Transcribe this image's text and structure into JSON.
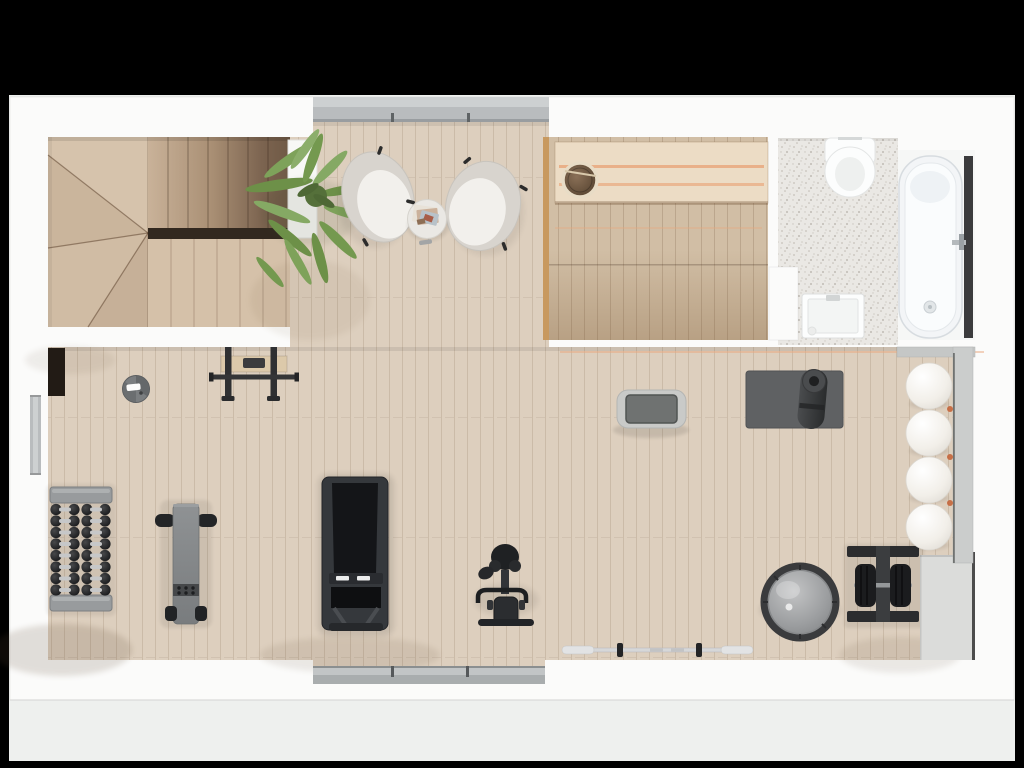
{
  "scene": {
    "type": "floor-plan-top-down-render",
    "title": "Residential floor plan with home gym, sauna and bathroom",
    "rooms": [
      {
        "name": "staircase-hall",
        "items": [
          "winder-staircase",
          "stair-gap",
          "potted-palm",
          "white-planter"
        ]
      },
      {
        "name": "lounge",
        "items": [
          "armchair-left",
          "armchair-right",
          "side-table",
          "magazines",
          "top-window"
        ]
      },
      {
        "name": "sauna",
        "items": [
          "sauna-bench",
          "sauna-bucket",
          "heated-glow-strips"
        ]
      },
      {
        "name": "bathroom",
        "items": [
          "wall-hung-toilet",
          "washbasin",
          "bathtub",
          "bath-mixer",
          "terrazzo-floor"
        ]
      },
      {
        "name": "gym",
        "items": [
          "dumbbell-rack",
          "flat-bench",
          "pull-up-bar",
          "air-purifier",
          "wall-niche",
          "treadmill",
          "exercise-bike",
          "step-platform",
          "yoga-mat",
          "mat-roll",
          "balance-dome",
          "plate-rack",
          "barbell",
          "stability-balls",
          "ball-rack",
          "left-window",
          "bottom-window"
        ]
      }
    ],
    "stability_ball_count": 4,
    "dumbbell_rows": 8,
    "dumbbell_columns": 2
  },
  "colors": {
    "frame": "#000000",
    "backdrop": "#eef0ee",
    "wall": "#fbfbfa",
    "wood_floor": "#ddcfbe",
    "wood_stair_light": "#cfbaa1",
    "wood_stair_dark": "#6f5945",
    "stair_gap": "#32281f",
    "sauna_floor": "#d1bea5",
    "sauna_bench": "#ecdcc5",
    "sauna_glow": "#e9a87e",
    "sauna_wall_edge": "#c8995f",
    "terrazzo_base": "#eae8e4",
    "fixture_white": "#fcfdfd",
    "tub_strip": "#3b3b3d",
    "window_gray": "#b9bcbe",
    "window_gray_light": "#cdd0d1",
    "window_gray_dark": "#999da0",
    "chair_shell": "#d8d4ce",
    "chair_cushion": "#f2f0ec",
    "plant_green": "#7ea25a",
    "plant_green_dark": "#55703a",
    "equipment_dark": "#2e3033",
    "equipment_gray": "#85888a",
    "metal_gray": "#c9cacc",
    "mat_gray": "#5f6163",
    "block_gray": "#dbdcda",
    "ball_white": "#f4f2ee",
    "niche_dark": "#221b15"
  }
}
